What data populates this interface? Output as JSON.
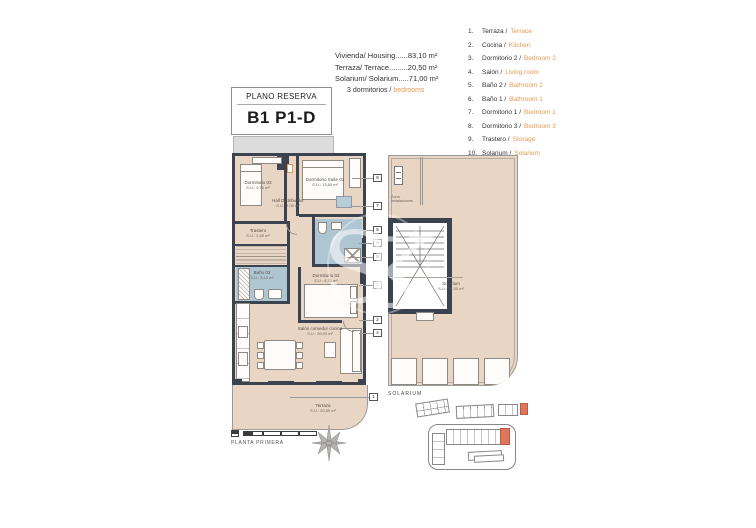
{
  "title_box": {
    "label": "PLANO RESERVA",
    "code": "B1 P1-D"
  },
  "summary": {
    "lines": [
      "Vivienda/ Housing......83,10 m²",
      "Terraza/ Terrace.........20,50 m²",
      "Solarium/ Solarium.....71,00 m²"
    ],
    "bedrooms_es": "3 dormitorios / ",
    "bedrooms_en": "bedrooms"
  },
  "legend": [
    {
      "num": "1.",
      "es": "Terraza / ",
      "en": "Terrace"
    },
    {
      "num": "2.",
      "es": "Cocina / ",
      "en": "Kitchen"
    },
    {
      "num": "3.",
      "es": "Dormitorio 2 / ",
      "en": "Bedroom 2"
    },
    {
      "num": "4.",
      "es": "Salón / ",
      "en": "Living room"
    },
    {
      "num": "5.",
      "es": "Baño 2 / ",
      "en": "Bathroom 2"
    },
    {
      "num": "6.",
      "es": "Baño 1 / ",
      "en": "Bathroom 1"
    },
    {
      "num": "7.",
      "es": "Dormitorio 1 / ",
      "en": "Bedroom 1"
    },
    {
      "num": "8.",
      "es": "Dormitorio 3 / ",
      "en": "Bedroom 3"
    },
    {
      "num": "9.",
      "es": "Trastero / ",
      "en": "Storage"
    },
    {
      "num": "10.",
      "es": "Solarium / ",
      "en": "Solarium"
    }
  ],
  "plan": {
    "rooms": {
      "dorm3": {
        "name": "Dormitorio 03",
        "area": "S.U.: 9,70 m²"
      },
      "suite": {
        "name": "Dormitorio Suite 01",
        "area": "S.U.: 13,60 m²"
      },
      "hall": {
        "name": "Hall Distribuidor",
        "area": "S.U.: 7,00 m²"
      },
      "trastero": {
        "name": "Trastero",
        "area": "S.U.: 2,65 m²"
      },
      "bano2": {
        "name": "Baño 02",
        "area": "S.U.: 3,10 m²"
      },
      "dorm2": {
        "name": "Dormitorio 02",
        "area": "S.U.: 8,75 m²"
      },
      "salon": {
        "name": "Salón comedor cocina",
        "area": "S.U.: 26,00 m²"
      },
      "terraza": {
        "name": "Terraza",
        "area": "S.U.: 20,50 m²"
      }
    },
    "callouts": [
      "8",
      "7",
      "5",
      "6",
      "9",
      "3",
      "2",
      "4"
    ],
    "terrace_callout": "1",
    "floor_label": "PLANTA PRIMERA"
  },
  "solarium": {
    "name": "Solarium",
    "area": "S.U.: 71,00 m²",
    "zone_note": "Zona instalaciones",
    "label": "SOLARIUM"
  },
  "watermark": {
    "letters": "SK"
  },
  "colors": {
    "accent": "#e59a52",
    "floor": "#e9d5c4",
    "wall": "#3b4250",
    "tile": "#aec5d2",
    "highlight": "#e0755c"
  }
}
